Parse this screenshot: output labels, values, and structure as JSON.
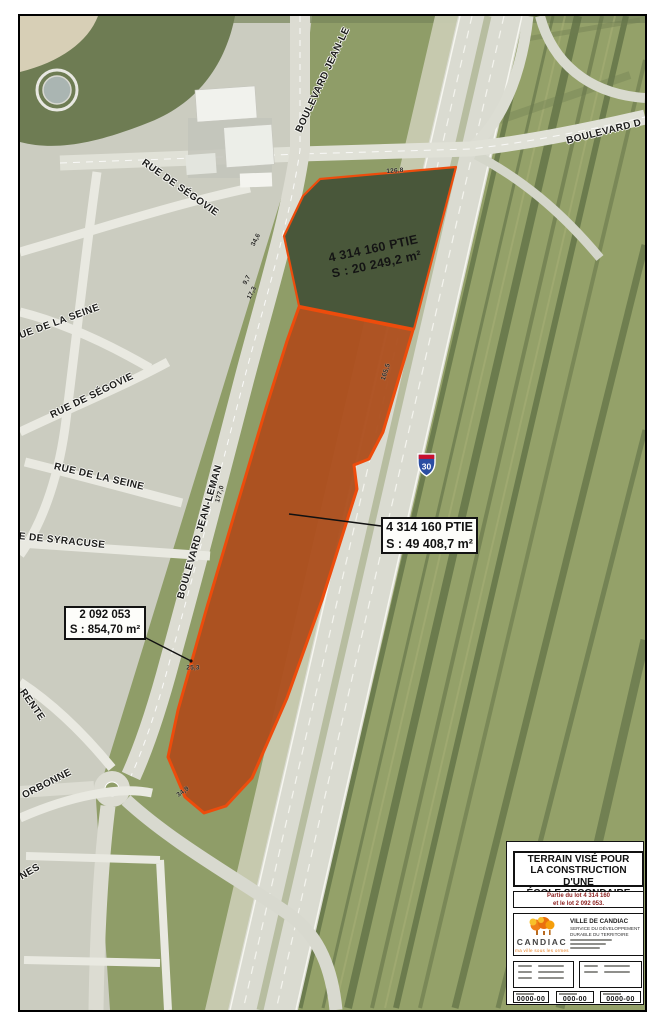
{
  "map": {
    "streets": {
      "blvd_jean_le_top": "BOULEVARD JEAN-LE",
      "blvd_d": "BOULEVARD D",
      "segovie_top": "RUE DE SÉGOVIE",
      "seine_1": "RUE DE LA SEINE",
      "segovie_2": "RUE DE SÉGOVIE",
      "seine_2": "RUE DE LA SEINE",
      "syracuse": "E DE SYRACUSE",
      "jean_leman": "BOULEVARD JEAN-LEMAN",
      "rente": "RENTE",
      "orbonne": "ORBONNE",
      "nes": "NES"
    },
    "highway_shield": "30",
    "parcels": {
      "north": {
        "lot": "4 314 160 PTIE",
        "area": "S : 20 249,2 m²"
      },
      "main": {
        "lot": "4 314 160 PTIE",
        "area": "S : 49 408,7 m²"
      },
      "small": {
        "lot": "2 092 053",
        "area": "S : 854,70 m²"
      }
    },
    "dimensions": {
      "d126": "126,8",
      "d346": "34,6",
      "d97": "9,7",
      "d173": "17,3",
      "d1655": "165,5",
      "d1770": "177,0",
      "d253": "25,3",
      "d349": "34,9"
    }
  },
  "title_block": {
    "title_line1": "TERRAIN VISÉ POUR",
    "title_line2": "LA CONSTRUCTION D'UNE",
    "title_line3": "ÉCOLE SECONDAIRE",
    "lot_line1": "Partie du lot 4 314 160",
    "lot_line2": "et le lot 2 092 053.",
    "logo_name": "CANDIAC",
    "logo_tagline": "ma ville sous les ormes",
    "org_line1": "VILLE DE CANDIAC",
    "org_line2": "SERVICE DU DÉVELOPPEMENT",
    "org_line3": "DURABLE DU TERRITOIRE",
    "file_no": "0000-00",
    "plan_no": "000-00",
    "sheet_no": "0000-00"
  },
  "colors": {
    "parcel_outline": "#ed4c0c",
    "parcel_fill": "#ad4f1e",
    "lot_text": "#8b1f1f",
    "logo_orange": "#f08019"
  }
}
